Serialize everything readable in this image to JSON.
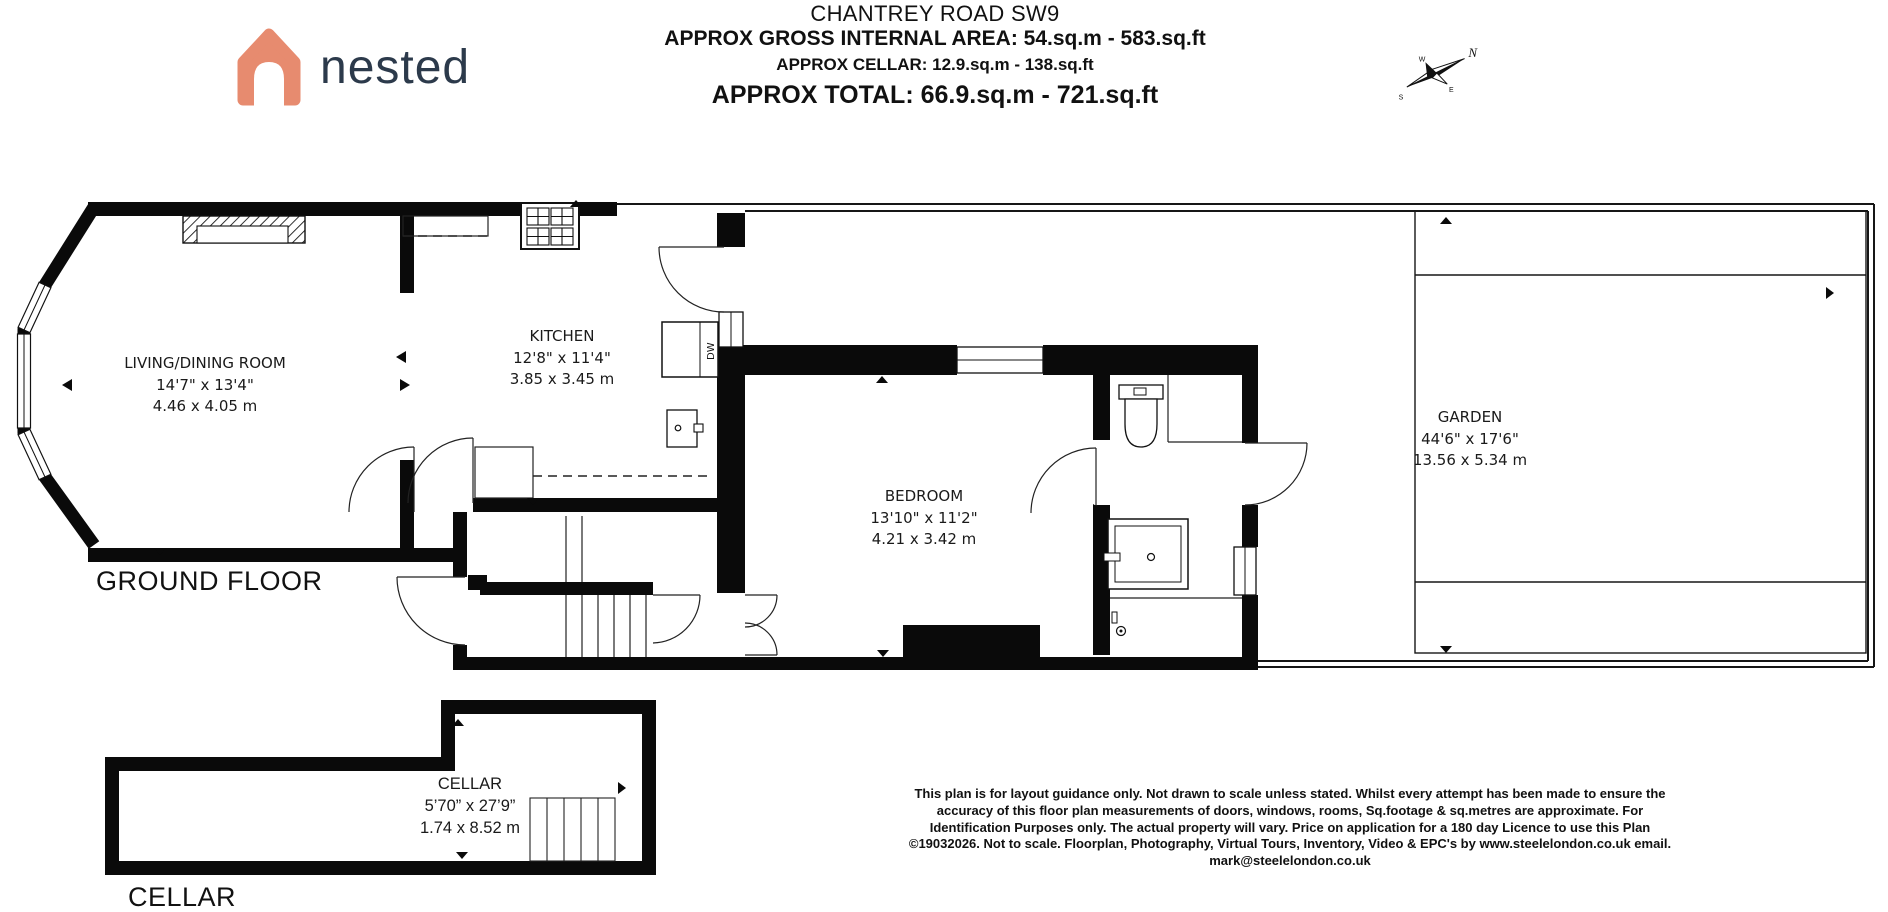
{
  "header": {
    "title": "CHANTREY ROAD SW9",
    "gross_area": "APPROX GROSS INTERNAL AREA: 54.sq.m - 583.sq.ft",
    "cellar_area": "APPROX CELLAR: 12.9.sq.m - 138.sq.ft",
    "total_area": "APPROX TOTAL: 66.9.sq.m - 721.sq.ft"
  },
  "logo": {
    "text": "nested",
    "house_color": "#e78b6f",
    "text_color": "#2c3a4b"
  },
  "compass": {
    "north": "N",
    "south": "S",
    "east": "E",
    "west": "W"
  },
  "floors": {
    "ground": {
      "label": "GROUND FLOOR",
      "rooms": [
        {
          "name": "LIVING/DINING ROOM",
          "imperial": "14'7\" x 13'4\"",
          "metric": "4.46 x 4.05 m"
        },
        {
          "name": "KITCHEN",
          "imperial": "12'8\" x 11'4\"",
          "metric": "3.85 x 3.45 m"
        },
        {
          "name": "BEDROOM",
          "imperial": "13'10\" x 11'2\"",
          "metric": "4.21 x 3.42 m"
        },
        {
          "name": "GARDEN",
          "imperial": "44'6\" x 17'6\"",
          "metric": "13.56 x 5.34 m"
        }
      ],
      "appliance_label": "DW"
    },
    "cellar": {
      "label": "CELLAR",
      "rooms": [
        {
          "name": "CELLAR",
          "imperial": "5’70” x 27’9”",
          "metric": "1.74 x 8.52 m"
        }
      ]
    }
  },
  "disclaimer": "This plan is for layout guidance only. Not drawn to scale unless stated. Whilst every attempt has been made to ensure the accuracy of this floor plan measurements of doors, windows, rooms, Sq.footage & sq.metres are approximate. For Identification Purposes only. The actual property will vary. Price on application for a 180 day Licence to use this Plan ©19032026. Not to scale. Floorplan, Photography, Virtual Tours, Inventory, Video & EPC's by www.steelelondon.co.uk  email. mark@steelelondon.co.uk"
}
